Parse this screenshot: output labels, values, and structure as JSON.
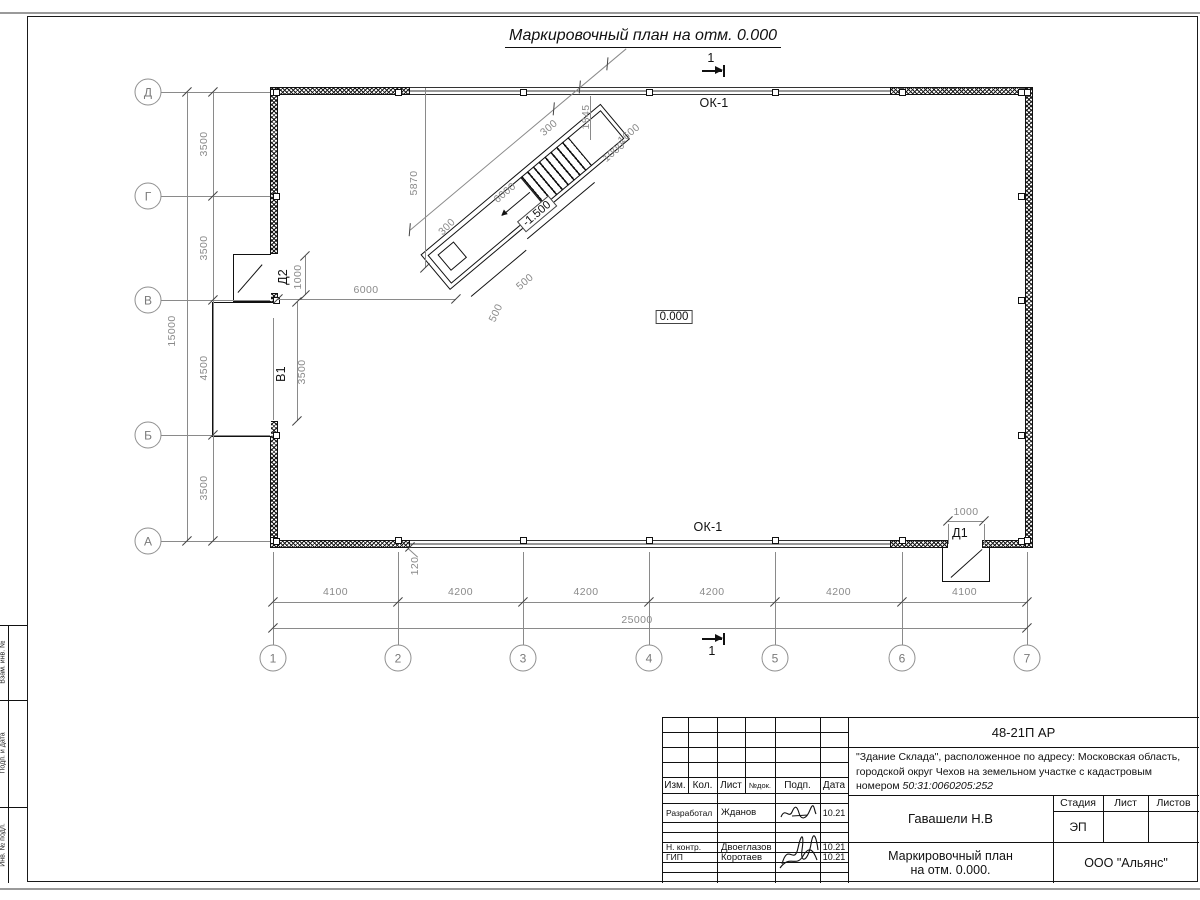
{
  "sheet": {
    "title": "Маркировочный план на отм. 0.000"
  },
  "plan": {
    "axes_bottom": [
      {
        "label": "1",
        "x": 273
      },
      {
        "label": "2",
        "x": 398
      },
      {
        "label": "3",
        "x": 523
      },
      {
        "label": "4",
        "x": 649
      },
      {
        "label": "5",
        "x": 775
      },
      {
        "label": "6",
        "x": 902
      },
      {
        "label": "7",
        "x": 1027
      }
    ],
    "axes_left": [
      {
        "label": "Д",
        "y": 92
      },
      {
        "label": "Г",
        "y": 196
      },
      {
        "label": "В",
        "y": 300
      },
      {
        "label": "Б",
        "y": 435
      },
      {
        "label": "А",
        "y": 541
      }
    ],
    "dims_bottom": [
      "4100",
      "4200",
      "4200",
      "4200",
      "4200",
      "4100"
    ],
    "dims_left": [
      "3500",
      "3500",
      "4500",
      "3500"
    ],
    "total_bottom": "25000",
    "total_left": "15000",
    "annotations": [
      {
        "text": "ОК-1",
        "x": 714,
        "y": 103,
        "rot": 0,
        "cls": "black"
      },
      {
        "text": "ОК-1",
        "x": 708,
        "y": 527,
        "rot": 0,
        "cls": "black"
      },
      {
        "text": "0.000",
        "x": 674,
        "y": 317,
        "rot": 0,
        "cls": "boxed"
      },
      {
        "text": "-1.500",
        "x": 537,
        "y": 214,
        "rot": -40,
        "cls": "boxed"
      },
      {
        "text": "Д1",
        "x": 960,
        "y": 533,
        "rot": 0,
        "cls": "black"
      },
      {
        "text": "1000",
        "x": 966,
        "y": 512,
        "rot": 0,
        "cls": ""
      },
      {
        "text": "Д2",
        "x": 283,
        "y": 277,
        "rot": -90,
        "cls": "black"
      },
      {
        "text": "1000",
        "x": 298,
        "y": 277,
        "rot": -90,
        "cls": ""
      },
      {
        "text": "В1",
        "x": 281,
        "y": 374,
        "rot": -90,
        "cls": "black"
      },
      {
        "text": "3500",
        "x": 302,
        "y": 372,
        "rot": -90,
        "cls": ""
      },
      {
        "text": "6000",
        "x": 366,
        "y": 290,
        "rot": 0,
        "cls": ""
      },
      {
        "text": "5870",
        "x": 414,
        "y": 183,
        "rot": -90,
        "cls": ""
      },
      {
        "text": "300",
        "x": 447,
        "y": 227,
        "rot": -45,
        "cls": ""
      },
      {
        "text": "6000",
        "x": 505,
        "y": 193,
        "rot": -40,
        "cls": ""
      },
      {
        "text": "300",
        "x": 549,
        "y": 128,
        "rot": -40,
        "cls": ""
      },
      {
        "text": "1845",
        "x": 586,
        "y": 117,
        "rot": -90,
        "cls": ""
      },
      {
        "text": "1600",
        "x": 629,
        "y": 134,
        "rot": -40,
        "cls": ""
      },
      {
        "text": "1000",
        "x": 614,
        "y": 152,
        "rot": -40,
        "cls": ""
      },
      {
        "text": "500",
        "x": 525,
        "y": 282,
        "rot": -40,
        "cls": ""
      },
      {
        "text": "500",
        "x": 496,
        "y": 313,
        "rot": -65,
        "cls": ""
      },
      {
        "text": "120",
        "x": 415,
        "y": 566,
        "rot": -90,
        "cls": ""
      },
      {
        "text": "25000",
        "x": 637,
        "y": 620,
        "rot": 0,
        "cls": ""
      },
      {
        "text": "15000",
        "x": 172,
        "y": 331,
        "rot": -90,
        "cls": ""
      },
      {
        "text": "1",
        "x": 711,
        "y": 58,
        "rot": 0,
        "cls": "black"
      },
      {
        "text": "1",
        "x": 712,
        "y": 651,
        "rot": 0,
        "cls": "black"
      }
    ],
    "lines": [
      [
        273,
        602,
        754,
        "h"
      ],
      [
        273,
        628,
        754,
        "h"
      ],
      [
        161,
        92,
        109,
        "h"
      ],
      [
        161,
        196,
        109,
        "h"
      ],
      [
        161,
        300,
        109,
        "h"
      ],
      [
        161,
        435,
        109,
        "h"
      ],
      [
        161,
        541,
        109,
        "h"
      ],
      [
        278,
        299,
        178,
        "h"
      ],
      [
        948,
        521,
        36,
        "h"
      ],
      [
        213,
        92,
        449,
        "v"
      ],
      [
        187,
        92,
        449,
        "v"
      ],
      [
        425,
        88,
        180,
        "v"
      ],
      [
        305,
        256,
        39,
        "v"
      ],
      [
        297,
        302,
        119,
        "v"
      ],
      [
        273,
        318,
        102,
        "v"
      ],
      [
        948,
        524,
        20,
        "v"
      ],
      [
        984,
        524,
        20,
        "v"
      ],
      [
        590,
        96,
        44,
        "v"
      ]
    ],
    "ticks": [
      [
        273,
        602
      ],
      [
        398,
        602
      ],
      [
        523,
        602
      ],
      [
        649,
        602
      ],
      [
        775,
        602
      ],
      [
        902,
        602
      ],
      [
        1027,
        602
      ],
      [
        273,
        628
      ],
      [
        1027,
        628
      ],
      [
        213,
        92
      ],
      [
        213,
        196
      ],
      [
        213,
        300
      ],
      [
        213,
        435
      ],
      [
        213,
        541
      ],
      [
        187,
        92
      ],
      [
        187,
        541
      ],
      [
        278,
        299
      ],
      [
        456,
        299
      ],
      [
        305,
        256
      ],
      [
        305,
        295
      ],
      [
        297,
        302
      ],
      [
        297,
        421
      ],
      [
        948,
        521
      ],
      [
        984,
        521
      ],
      [
        425,
        268
      ],
      [
        410,
        547
      ]
    ]
  },
  "titleblock": {
    "doc_number": "48-21П АР",
    "description_prefix": "\"Здание Склада\", расположенное по адресу: Московская область, городской округ Чехов на земельном участке с кадастровым номером ",
    "cadastral_number": "50:31:0060205:252",
    "cols": [
      "Изм.",
      "Кол.",
      "Лист",
      "№док.",
      "Подп.",
      "Дата"
    ],
    "rows": [
      {
        "role": "Разработал",
        "name": "Жданов",
        "date": "10.21"
      },
      {
        "role": "Н. контр.",
        "name": "Двоеглазов",
        "date": "10.21"
      },
      {
        "role": "ГИП",
        "name": "Коротаев",
        "date": "10.21"
      }
    ],
    "client": "Гавашели Н.В",
    "sheet_title": "Маркировочный план\nна отм. 0.000.",
    "company": "ООО \"Альянс\"",
    "stage_label": "Стадия",
    "list_label": "Лист",
    "sheets_label": "Листов",
    "stage_value": "ЭП"
  },
  "margin_labels": [
    "Взам. инв. №",
    "Подп. и дата",
    "Инв. № подл."
  ]
}
